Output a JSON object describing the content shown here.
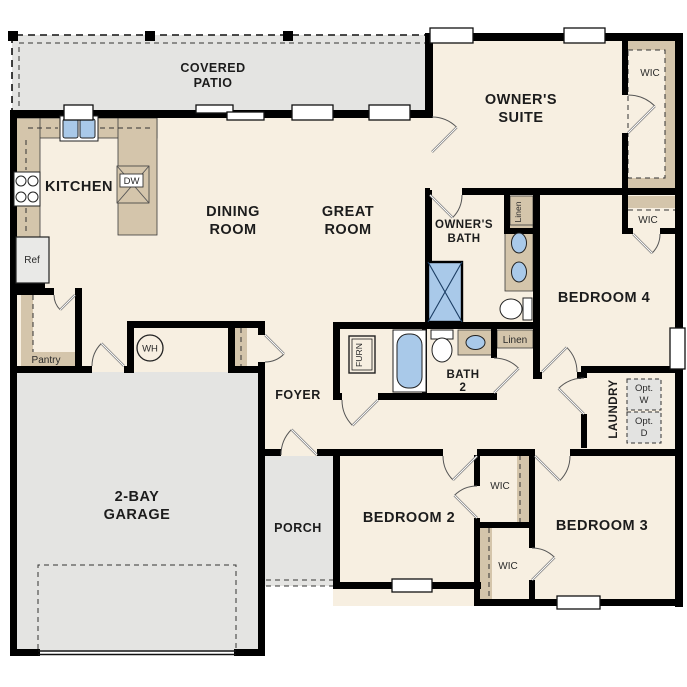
{
  "plan_title": "Single-story floor plan",
  "colors": {
    "floor": "#f7efe1",
    "exterior_concrete": "#e4e4e2",
    "cabinetry": "#d4c5ab",
    "plumbing_fixture_blue": "#a9c9e9",
    "wall": "#000000"
  },
  "labels": {
    "covered_patio": [
      "COVERED",
      "PATIO"
    ],
    "kitchen": "KITCHEN",
    "dining_room": [
      "DINING",
      "ROOM"
    ],
    "great_room": [
      "GREAT",
      "ROOM"
    ],
    "owners_suite": [
      "OWNER'S",
      "SUITE"
    ],
    "owners_bath": [
      "OWNER'S",
      "BATH"
    ],
    "bedroom_4": "BEDROOM 4",
    "bath_2": [
      "BATH",
      "2"
    ],
    "foyer": "FOYER",
    "laundry": "LAUNDRY",
    "porch": "PORCH",
    "garage": [
      "2-BAY",
      "GARAGE"
    ],
    "bedroom_2": "BEDROOM 2",
    "bedroom_3": "BEDROOM 3",
    "pantry": "Pantry",
    "wic": "WIC",
    "linen": "Linen",
    "ref": "Ref",
    "dw": "DW",
    "wh": "WH",
    "furn": "FURN",
    "opt_washer": [
      "Opt.",
      "W"
    ],
    "opt_dryer": [
      "Opt.",
      "D"
    ]
  }
}
